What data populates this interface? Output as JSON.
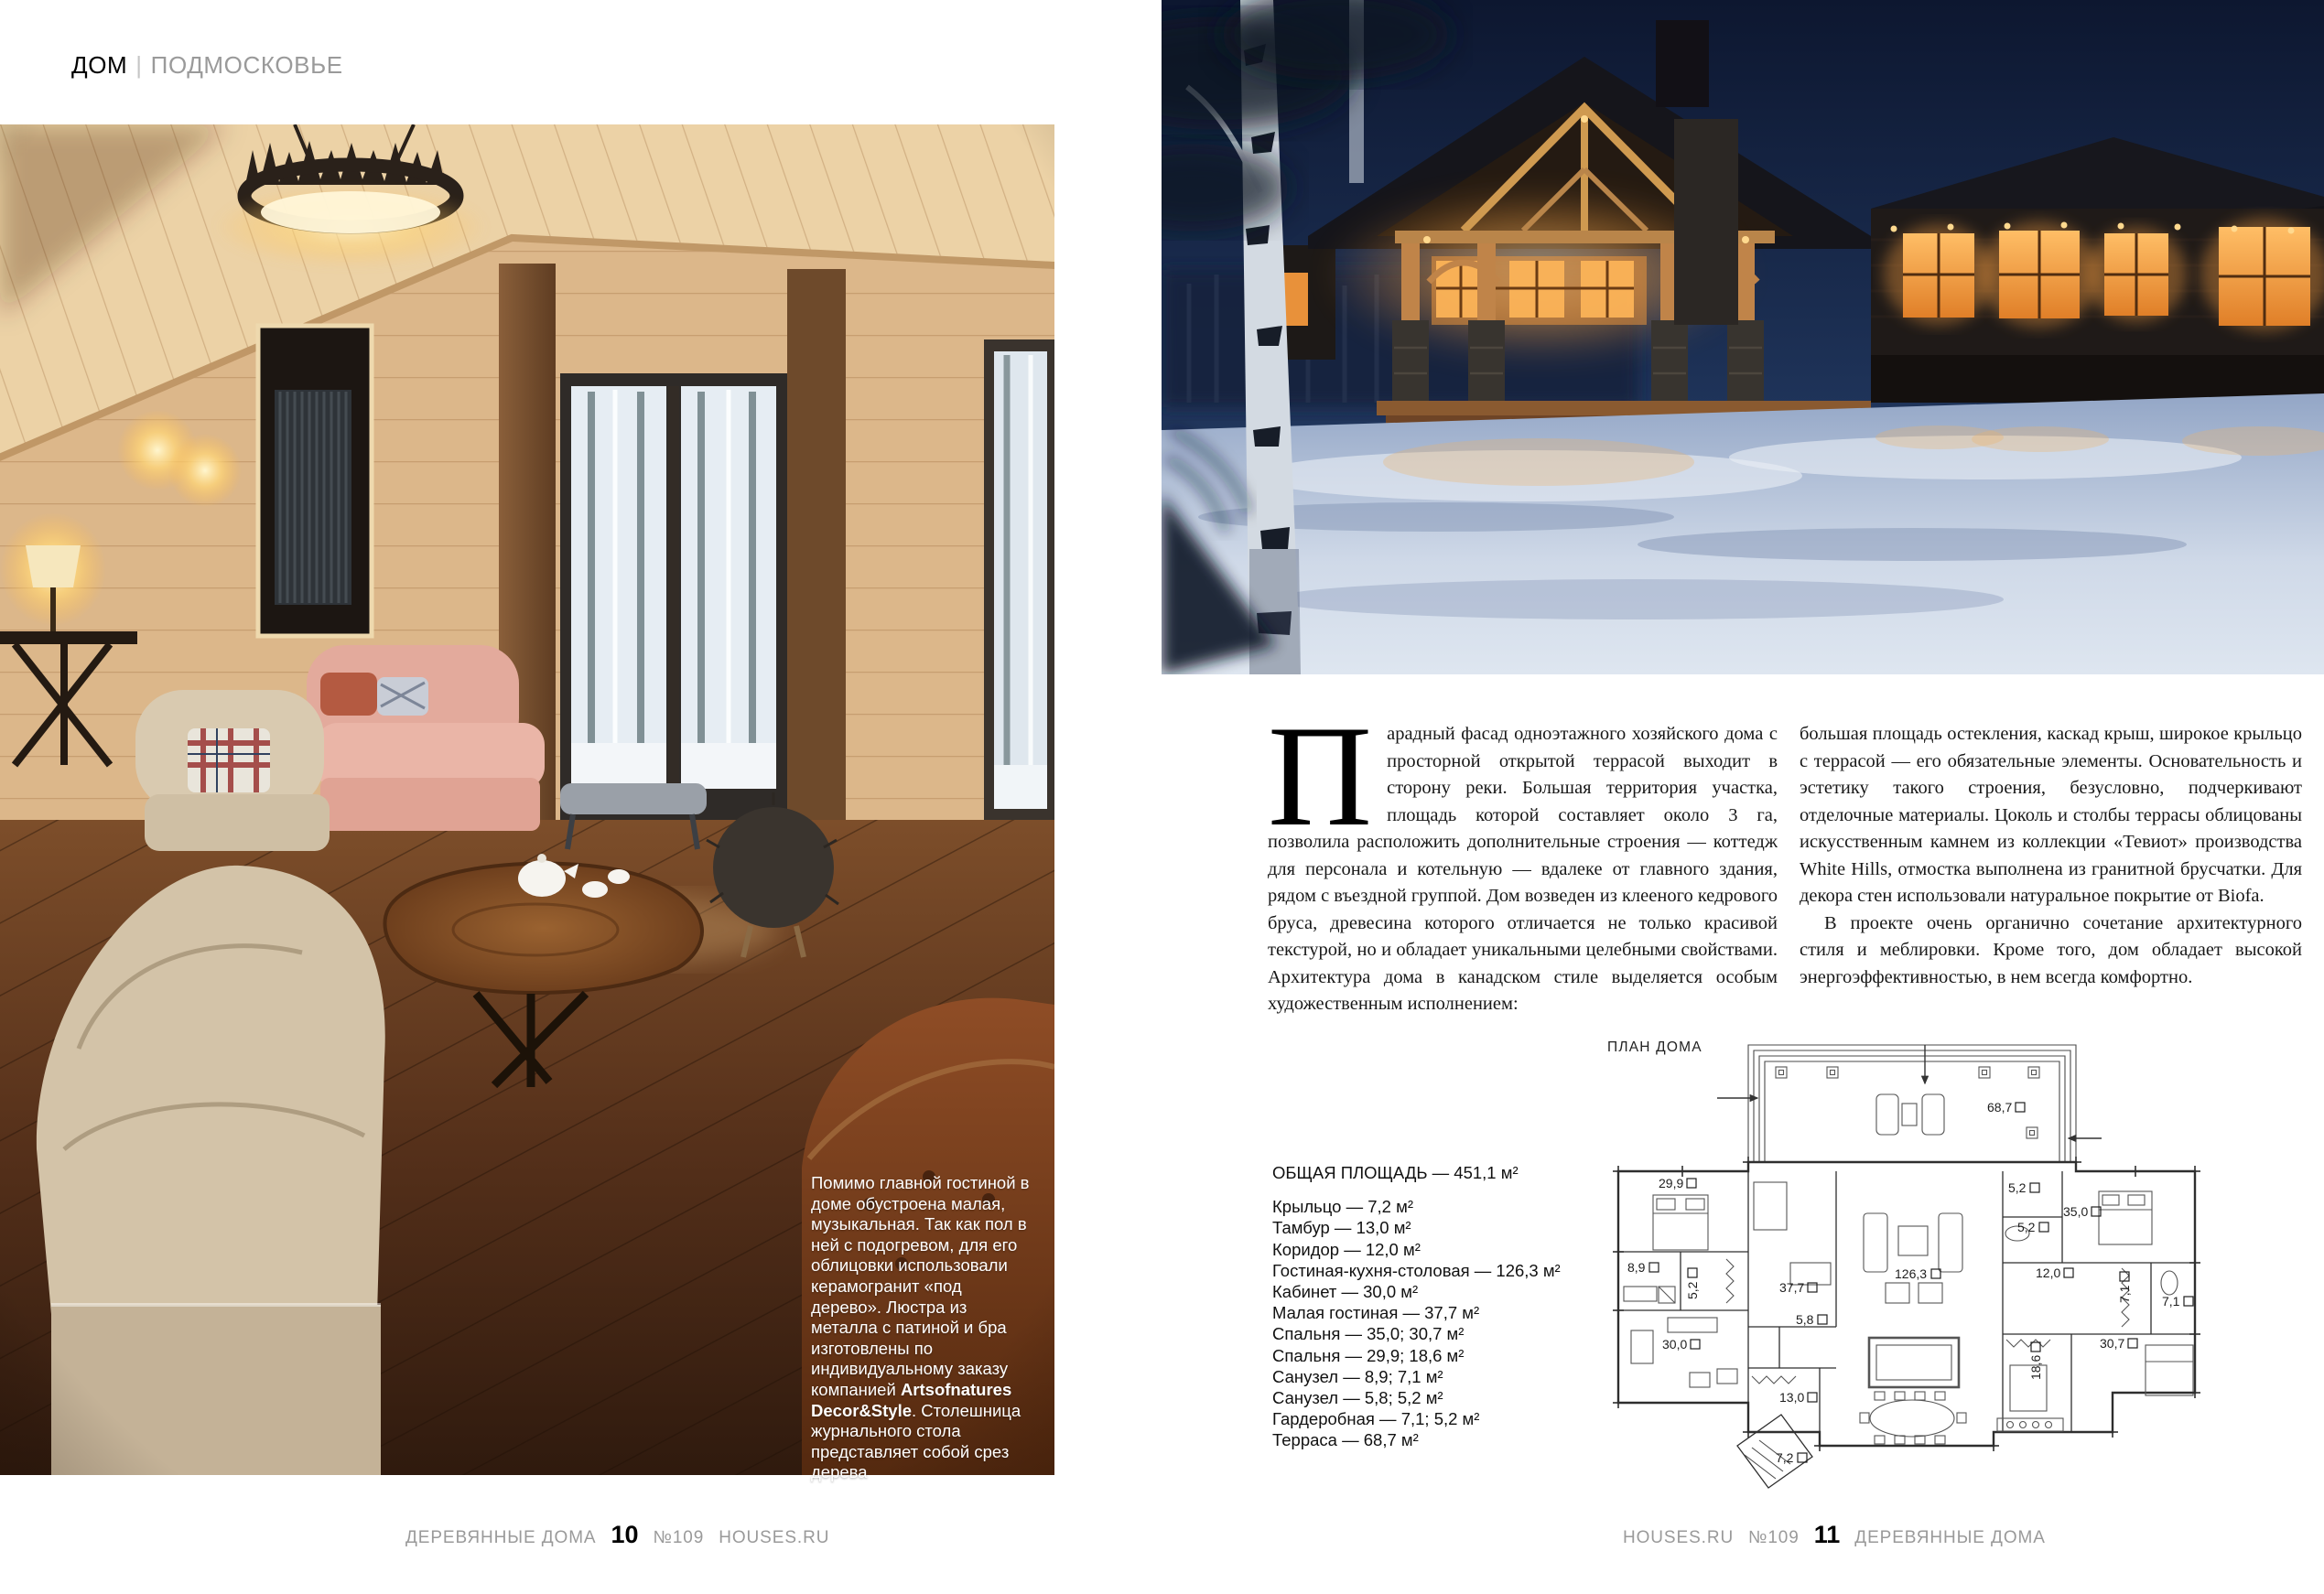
{
  "colors": {
    "page_bg": "#ffffff",
    "muted_gray": "#9a9a9a",
    "text": "#1c1c1c"
  },
  "page_left": {
    "header": {
      "section": "ДОМ",
      "separator": "|",
      "region": "ПОДМОСКОВЬЕ"
    },
    "photo_caption": {
      "text_before": "Помимо главной гостиной в доме обустроена малая, музыкальная. Так как пол в ней с подогревом, для его облицовки использовали керамогранит «под дерево». Люстра из металла с патиной и бра изготовлены по индивидуальному заказу компанией ",
      "brand": "Artsofnatures Decor&Style",
      "text_after": ". Столешница журнального стола представляет собой срез дерева"
    },
    "footer": {
      "magazine": "ДЕРЕВЯННЫЕ ДОМА",
      "page_number": "10",
      "issue": "№109",
      "site": "HOUSES.RU"
    }
  },
  "page_right": {
    "article": {
      "drop_cap": "П",
      "col1_text": "арадный фасад одноэтажного хозяйского дома с просторной открытой террасой выходит в сторону реки. Большая территория участка, площадь которой составляет около 3 га, позволила расположить дополнительные строения — коттедж для персонала и котельную — вдалеке от главного здания, рядом с въездной группой. Дом возведен из клееного кедрового бруса, древесина которого отличается не только красивой текстурой, но и обладает уникальными целебными свойствами. Архитектура дома в канадском стиле выделяется особым художественным исполнением:",
      "col2_para1": "большая площадь остекления, каскад крыш, широкое крыльцо с террасой — его обязательные элементы. Основательность и эстетику такого строения, безусловно, подчеркивают отделочные материалы. Цоколь и столбы террасы облицованы искусственным камнем из коллекции «Тевиот» производства White Hills, отмостка выполнена из гранитной брусчатки. Для декора стен использовали натуральное покрытие от Biofa.",
      "col2_para2": "В проекте очень органично сочетание архитектурного стиля и меблировки. Кроме того, дом обладает высокой энергоэффективностью, в нем всегда комфортно."
    },
    "plan": {
      "title": "ПЛАН ДОМА",
      "labels": [
        "68,7",
        "29,9",
        "5,2",
        "35,0",
        "5,2",
        "8,9",
        "5,2",
        "37,7",
        "126,3",
        "12,0",
        "7,1",
        "7,1",
        "5,8",
        "30,0",
        "18,6",
        "30,7",
        "13,0",
        "7,2"
      ]
    },
    "areas": {
      "title": "ОБЩАЯ ПЛОЩАДЬ — 451,1 м²",
      "items": [
        "Крыльцо — 7,2 м²",
        "Тамбур — 13,0 м²",
        "Коридор — 12,0 м²",
        "Гостиная-кухня-столовая — 126,3 м²",
        "Кабинет — 30,0 м²",
        "Малая гостиная — 37,7 м²",
        "Спальня — 35,0; 30,7 м²",
        "Спальня — 29,9; 18,6 м²",
        "Санузел — 8,9; 7,1 м²",
        "Санузел — 5,8; 5,2 м²",
        "Гардеробная — 7,1; 5,2 м²",
        "Терраса — 68,7 м²"
      ]
    },
    "footer": {
      "site": "HOUSES.RU",
      "issue": "№109",
      "page_number": "11",
      "magazine": "ДЕРЕВЯННЫЕ ДОМА"
    }
  }
}
